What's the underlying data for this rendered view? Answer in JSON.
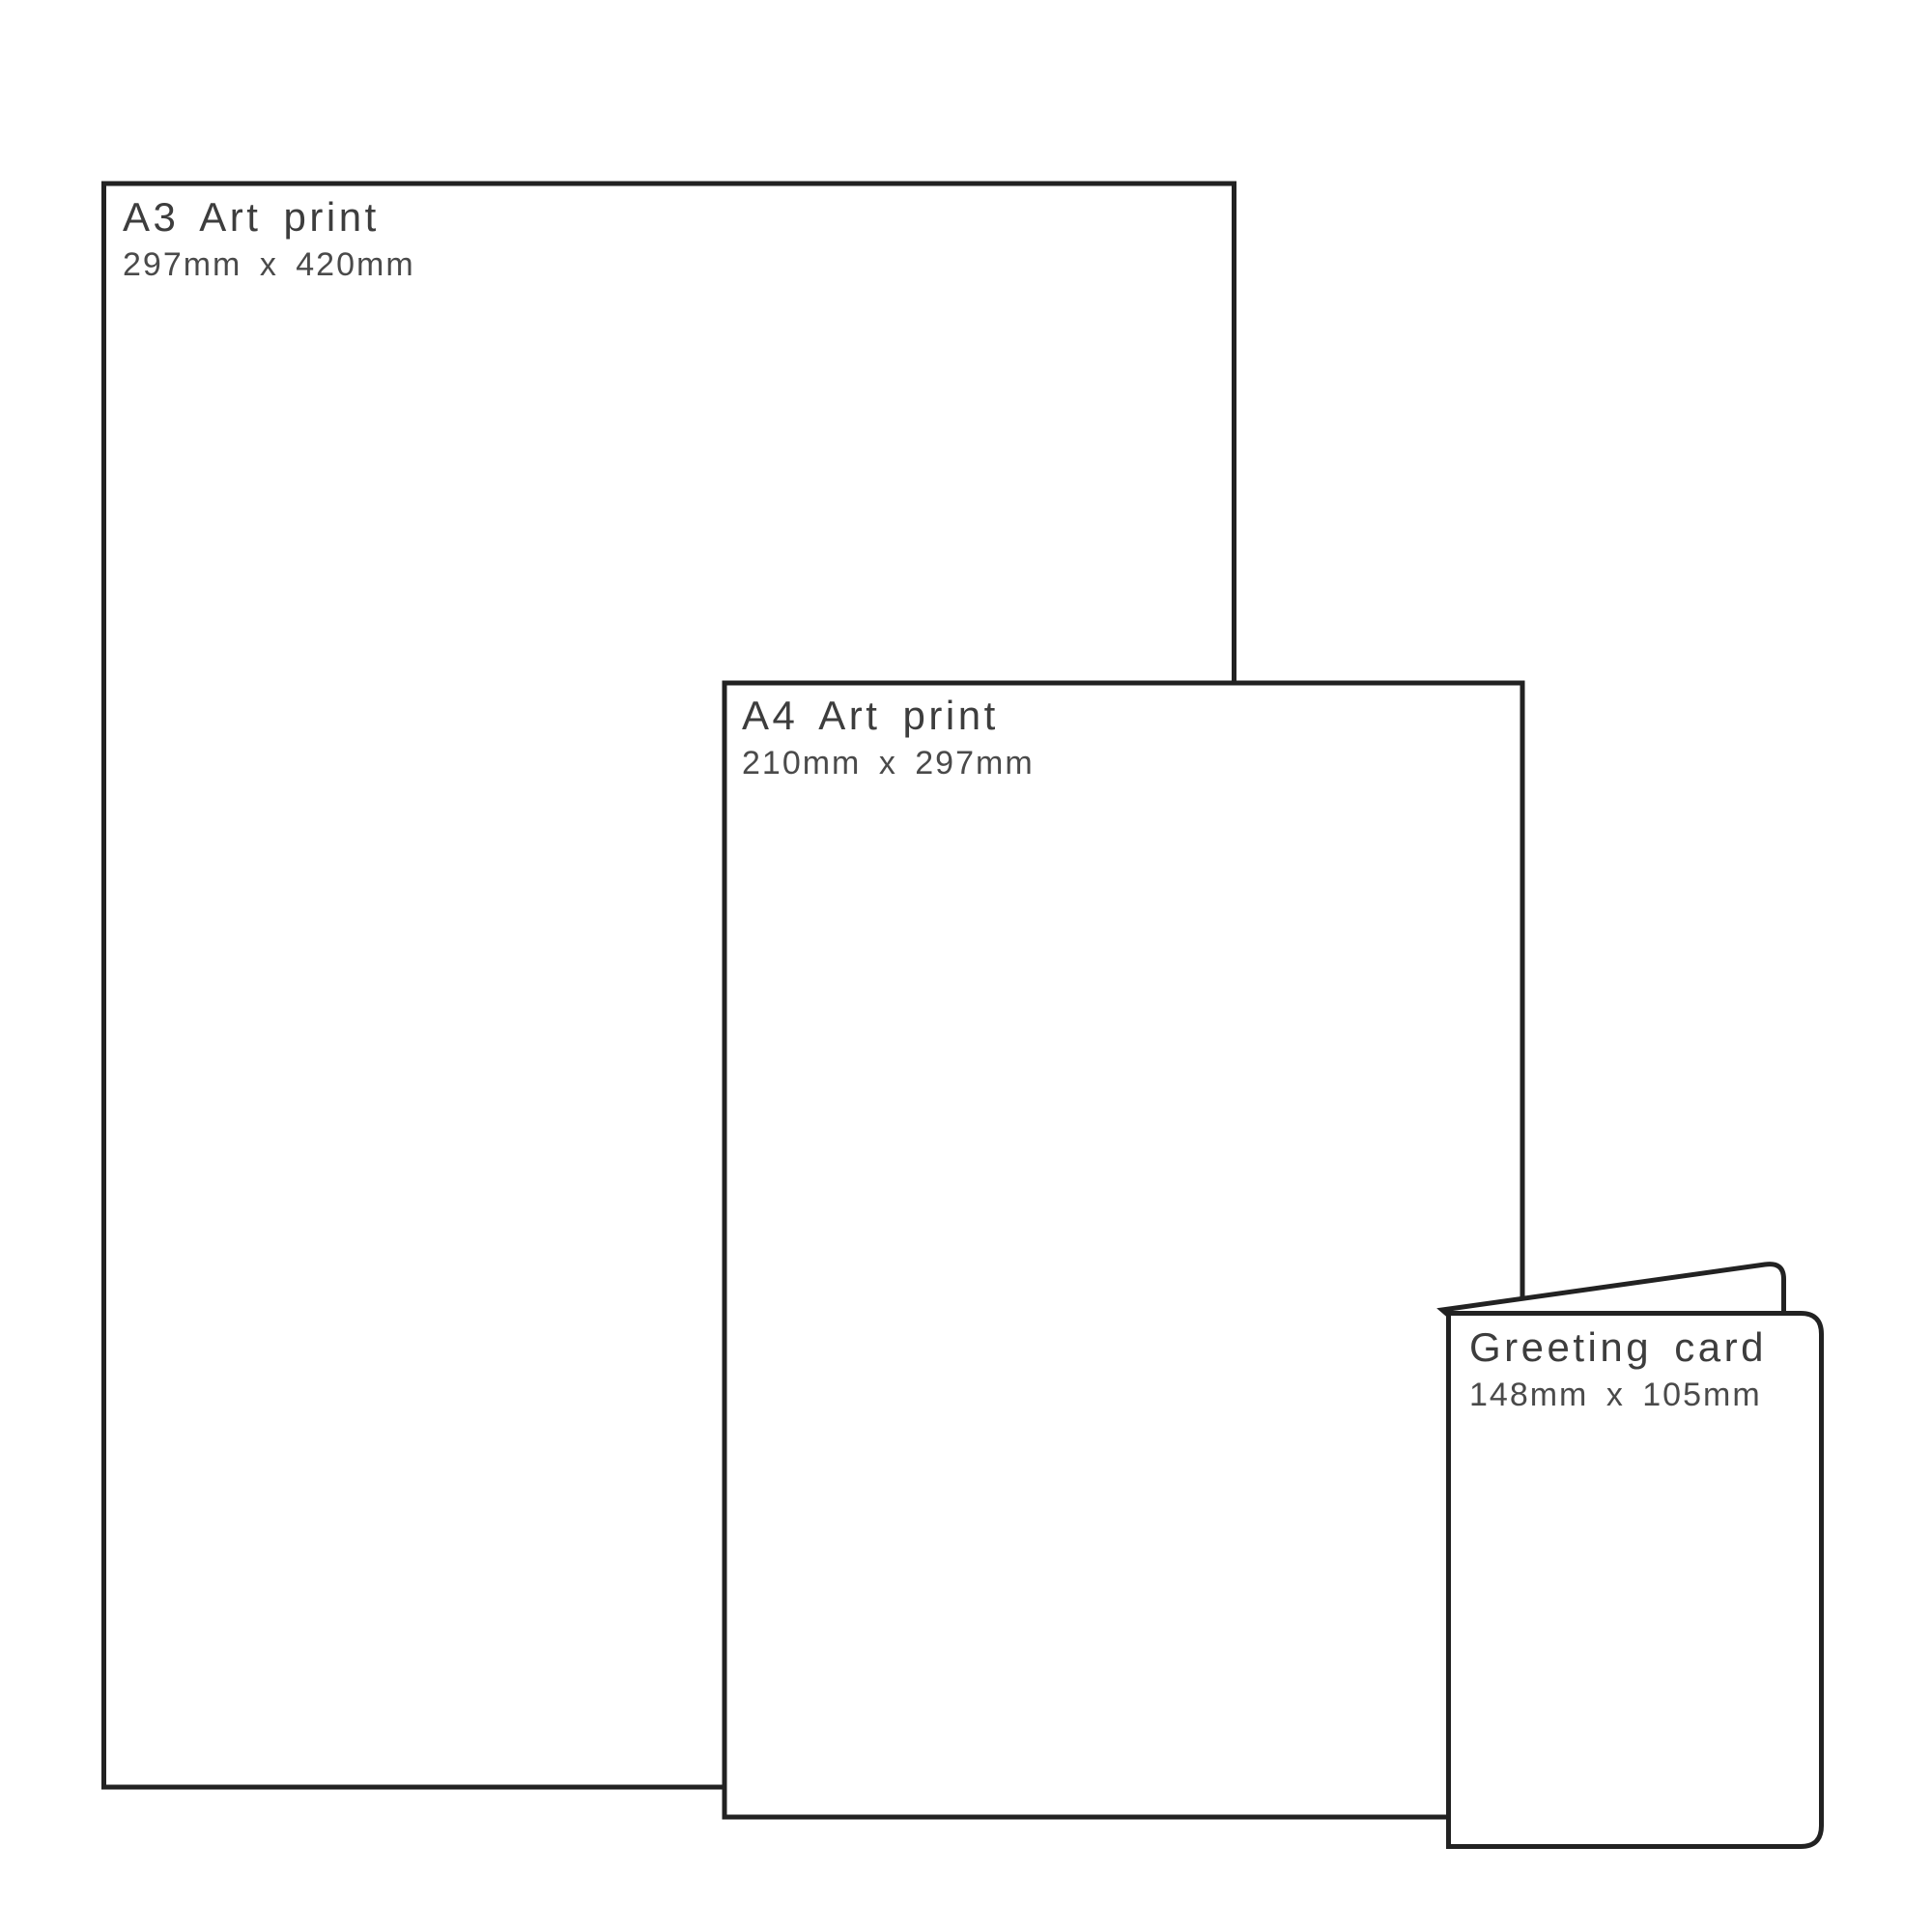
{
  "figure": {
    "type": "print-size-comparison-diagram",
    "background_color": "#ffffff",
    "line_color": "#222222",
    "title_color": "#3d3d3d",
    "subtitle_color": "#4a4a4a"
  },
  "items": [
    {
      "name": "a3-art-print",
      "label": "A3 Art print",
      "size": "297mm x 420mm"
    },
    {
      "name": "a4-art-print",
      "label": "A4 Art print",
      "size": "210mm x 297mm"
    },
    {
      "name": "greeting-card",
      "label": "Greeting card",
      "size": "148mm x 105mm"
    }
  ]
}
